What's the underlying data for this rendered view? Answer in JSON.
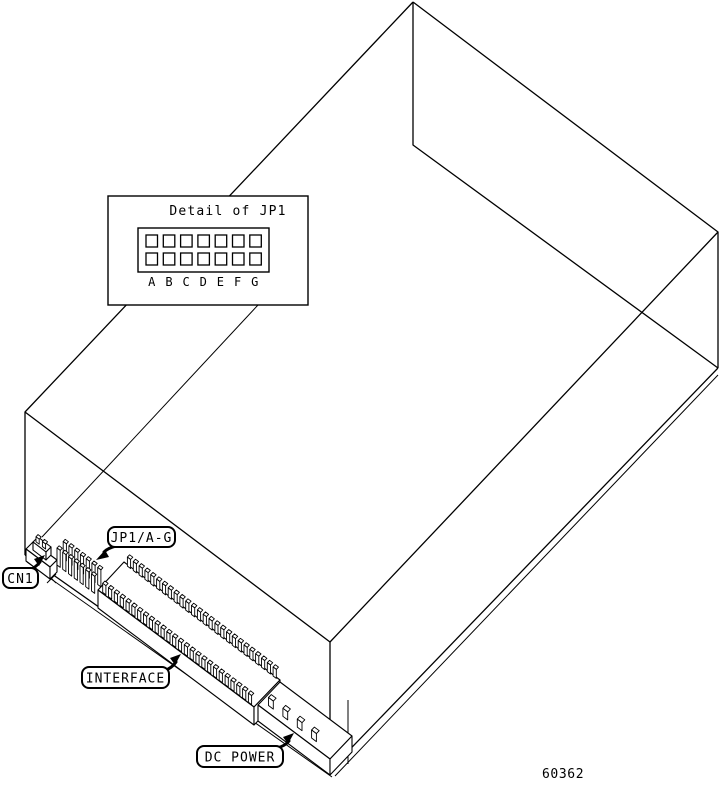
{
  "figure": {
    "description": "Isometric line drawing of a disk drive showing rear connector locations",
    "part_number": "60362",
    "detail_box": {
      "title": "Detail of JP1",
      "jumper_labels": [
        "A",
        "B",
        "C",
        "D",
        "E",
        "F",
        "G"
      ],
      "pin_rows": 2,
      "pin_columns": 7
    },
    "callouts": {
      "cn1": "CN1",
      "jp1": "JP1/A-G",
      "interface": "INTERFACE",
      "dc_power": "DC POWER"
    },
    "connectors_drawn": {
      "cn1_pin_count": 2,
      "jp1_pin_rows": 2,
      "jp1_pin_columns": 7,
      "interface_pin_rows": 2,
      "interface_pins_per_row": 26,
      "dc_power_pin_count": 4
    },
    "colors": {
      "line": "#000000",
      "background": "#ffffff"
    }
  }
}
